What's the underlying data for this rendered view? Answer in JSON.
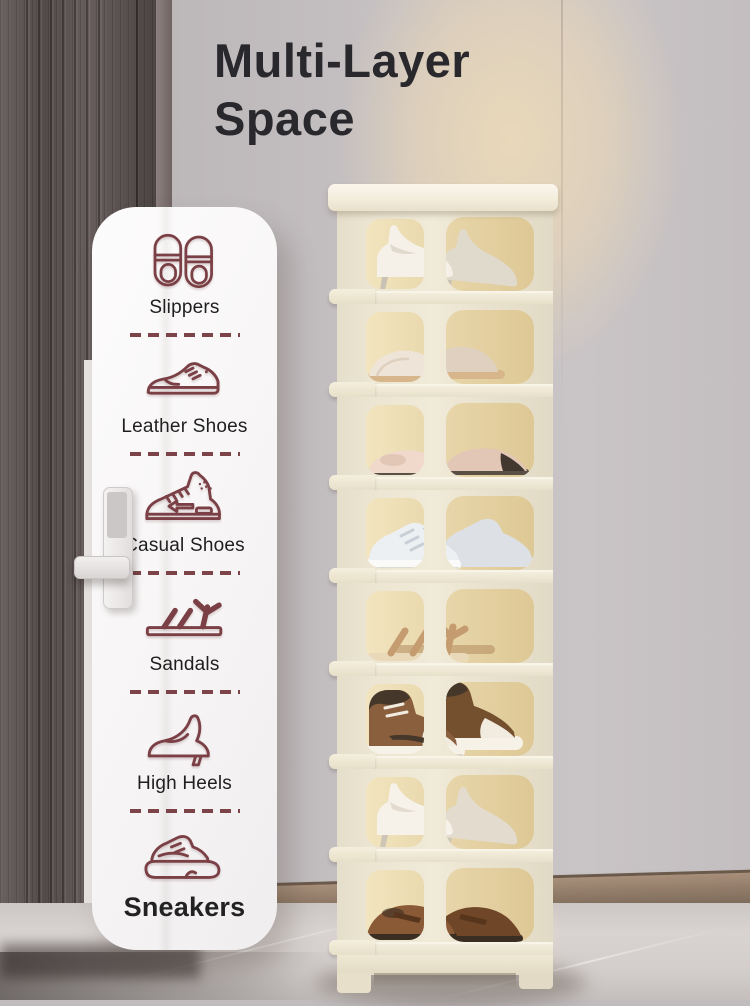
{
  "title": {
    "line1": "Multi-Layer",
    "line2": "Space"
  },
  "card": {
    "items": [
      {
        "icon": "slippers-icon",
        "label": "Slippers"
      },
      {
        "icon": "leather-shoes-icon",
        "label": "Leather Shoes"
      },
      {
        "icon": "casual-shoes-icon",
        "label": "Casual Shoes"
      },
      {
        "icon": "sandals-icon",
        "label": "Sandals"
      },
      {
        "icon": "high-heels-icon",
        "label": "High Heels"
      },
      {
        "icon": "sneakers-icon",
        "label": "Sneakers",
        "emphasized": true
      }
    ]
  },
  "rack": {
    "tier_count": 8,
    "tiers": [
      {
        "shoe": "white-high-heels",
        "type": "pumps",
        "colors": {
          "main": "#f5f1e9",
          "shade": "#e0dacd",
          "dark": "#c9c2b4"
        }
      },
      {
        "shoe": "beige-slippers",
        "type": "slippers",
        "colors": {
          "main": "#efe4d8",
          "shade": "#dfd0bf",
          "sole": "#d7b68b"
        }
      },
      {
        "shoe": "cap-toe-ballet-flats",
        "type": "flats",
        "colors": {
          "main": "#f0d8ca",
          "shade": "#e2c6b6",
          "cap": "#43382f",
          "sole": "#5a4f45"
        }
      },
      {
        "shoe": "white-sneakers",
        "type": "sneakers",
        "colors": {
          "main": "#edf0f3",
          "shade": "#dde1e6",
          "sole": "#fafaf8",
          "lace": "#c9cfd6"
        }
      },
      {
        "shoe": "tan-strappy-sandals",
        "type": "sandals",
        "colors": {
          "main": "#c59c6f",
          "shade": "#b28a5e",
          "sole": "#ead9b8"
        }
      },
      {
        "shoe": "brown-high-top-sneakers",
        "type": "hightops",
        "colors": {
          "main": "#8a5f3e",
          "shade": "#74502f",
          "dark": "#453729",
          "light": "#f2ece0",
          "sole": "#f6f2e8"
        }
      },
      {
        "shoe": "white-heels",
        "type": "pumps",
        "colors": {
          "main": "#f6f2ea",
          "shade": "#e3dcce",
          "dark": "#cdc5b6"
        }
      },
      {
        "shoe": "brown-loafers",
        "type": "loafers",
        "colors": {
          "main": "#8a5a36",
          "shade": "#6f4628",
          "dark": "#3a2e23",
          "strap": "#56351c"
        }
      }
    ]
  },
  "palette": {
    "accent": "#7a4045",
    "title_text": "#29282c",
    "label_text": "#1f1f1f",
    "card_bg": "#f9f7f7",
    "rack_frame": "#ebe4d0",
    "rack_inner": "#e6d3a8",
    "wall": "#c1bcbe",
    "door": "#5e5453",
    "floor": "#d6d1cf",
    "baseboard": "#937d6a"
  }
}
